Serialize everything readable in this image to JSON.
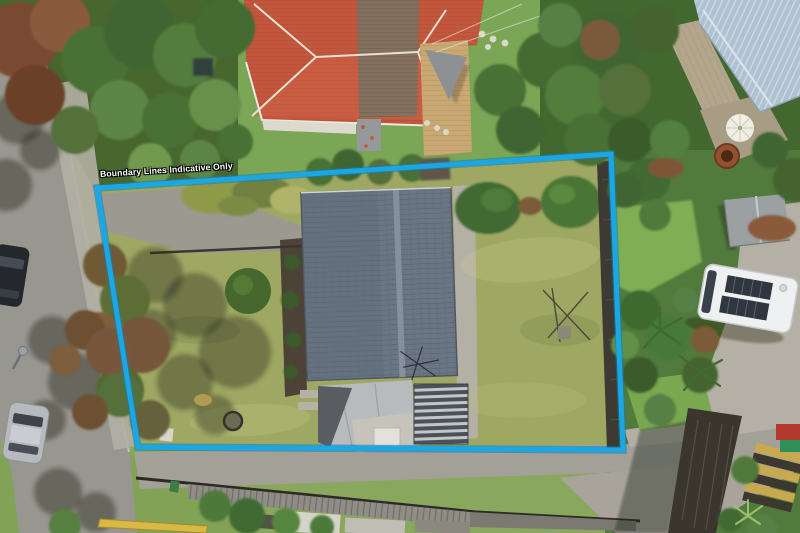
{
  "overlay": {
    "boundary_label": "Boundary Lines Indicative Only",
    "boundary_color": "#1CA6E2",
    "boundary_underlay_color": "#0E7FB4"
  }
}
